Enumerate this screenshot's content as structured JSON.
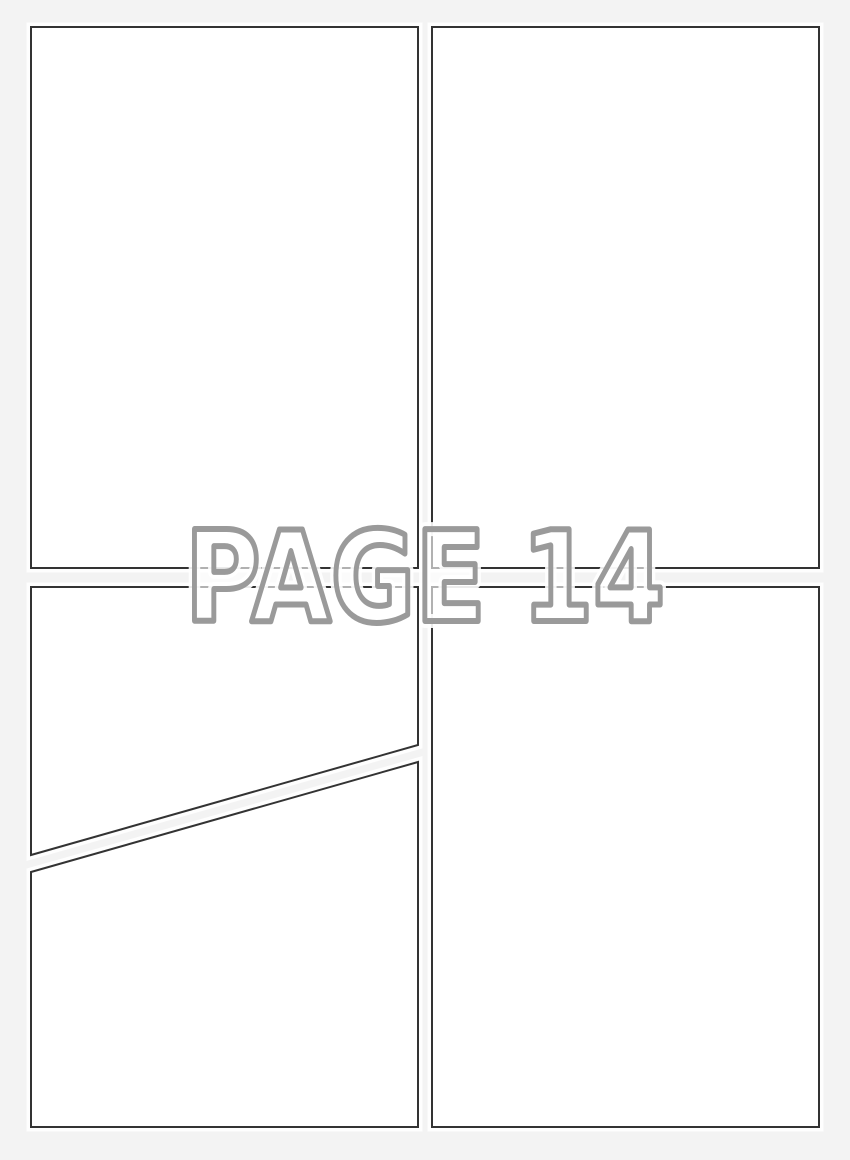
{
  "watermark": {
    "label": "PAGE 14"
  },
  "colors": {
    "background": "#f3f3f3",
    "panel_fill": "#ffffff",
    "panel_border": "#333333",
    "panel_halo": "rgba(255,255,255,0.85)",
    "watermark_fill": "rgba(255,255,255,0.62)",
    "watermark_outline": "#9a9a9a",
    "watermark_halo": "rgba(255,255,255,0.9)"
  }
}
